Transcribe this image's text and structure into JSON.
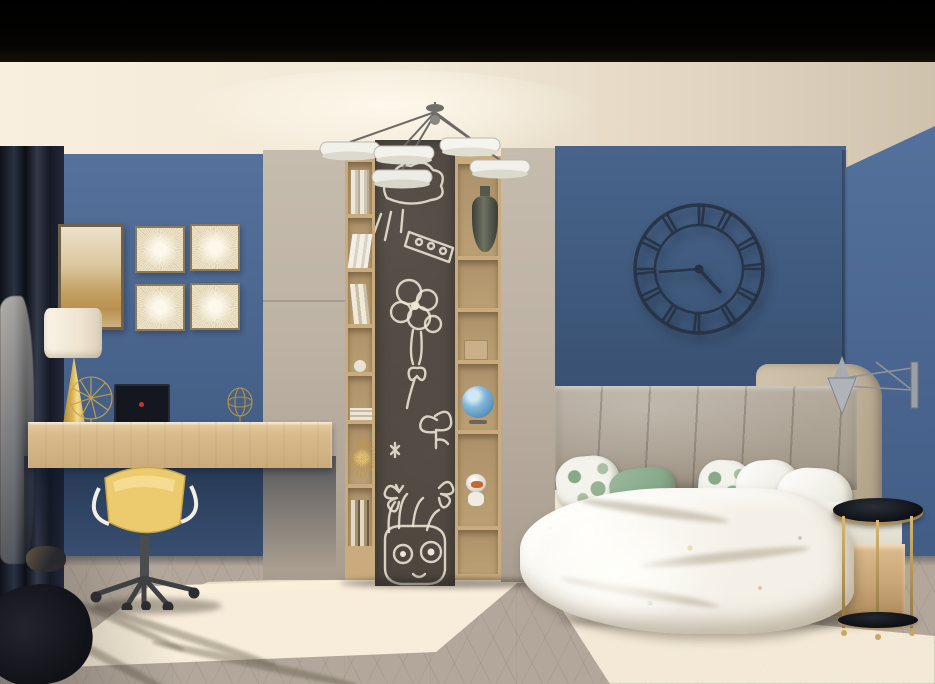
{
  "scene": {
    "title": "Children's bedroom interior render",
    "regions": {
      "stage": "3D render of a kids bedroom with blue walls, desk nook, chalkboard shelf unit and bed",
      "black_band": "dark soffit band across the top of the image",
      "ceiling": "cream ceiling lit warmly from the left",
      "wall_left": "blue accent wall behind the desk",
      "wall_back": "blue wall behind the bed",
      "wall_right": "blue wall on the right side of the corner",
      "floor": "light chevron-parquet floor with bright sunlight patches",
      "curtain": "dark navy drape with sheer white curtain, tied back, far left",
      "artwork": "one large gold abstract canvas and four square dandelion prints",
      "wardrobe": "tall greige wardrobe panels flanking the shelf unit",
      "shelf_unit": "oak shelving columns with books, vase, gift box, globe, astronaut toy and gold starburst",
      "chalkboard": "tall chalkboard panel with white chalk doodles: sun, balloon bouquet, plant, butterflies and a Groot face",
      "clock": "black roman-numeral skeleton wall clock",
      "chandelier": "modern chandelier with five white disc lights on dark arms",
      "bed": "bed with grey upholstered headboard panels, tropical and sage pillows, white floral duvet on oak base",
      "wall_lamp": "chrome double-cone swing-arm wall lamp above the bed",
      "side_table": "round black glass side table with brass legs",
      "desk": "floating oak desk with brass lamp, wire fan ornament, dark laptop and wire sphere",
      "chair": "yellow shell swivel chair with white armrests on castors"
    },
    "clock_reading": "approximately 4:45",
    "counts": {
      "chandelier_discs": 5,
      "square_prints": 4,
      "pillows": 6
    }
  },
  "palette": {
    "ceiling": "#f0e7d7",
    "wall-left": "#4c6790",
    "wall-back": "#3f5a7d",
    "wall-right": "#4a6690",
    "cabinet": "#bdb2a4",
    "shelf-wood": "#c9ab7e",
    "chalkboard": "#4a443c",
    "chalk": "#ece6d6",
    "desk": "#d8ba8b",
    "chair-yellow": "#e9c868",
    "floor": "#b2a79a",
    "sunlight": "#fdf3df",
    "headboard": "#a99f91",
    "headboard-wing": "#c3b49c",
    "bedframe": "#c9a577",
    "duvet": "#f4f0e7",
    "pillow-sage": "#87a98b",
    "table-black": "#15171c",
    "brass": "#b08d52",
    "clock-black": "#273142",
    "metal": "#9aa0a6",
    "globe": "#7fb6d9",
    "lamp-gold": "#d9b356"
  }
}
